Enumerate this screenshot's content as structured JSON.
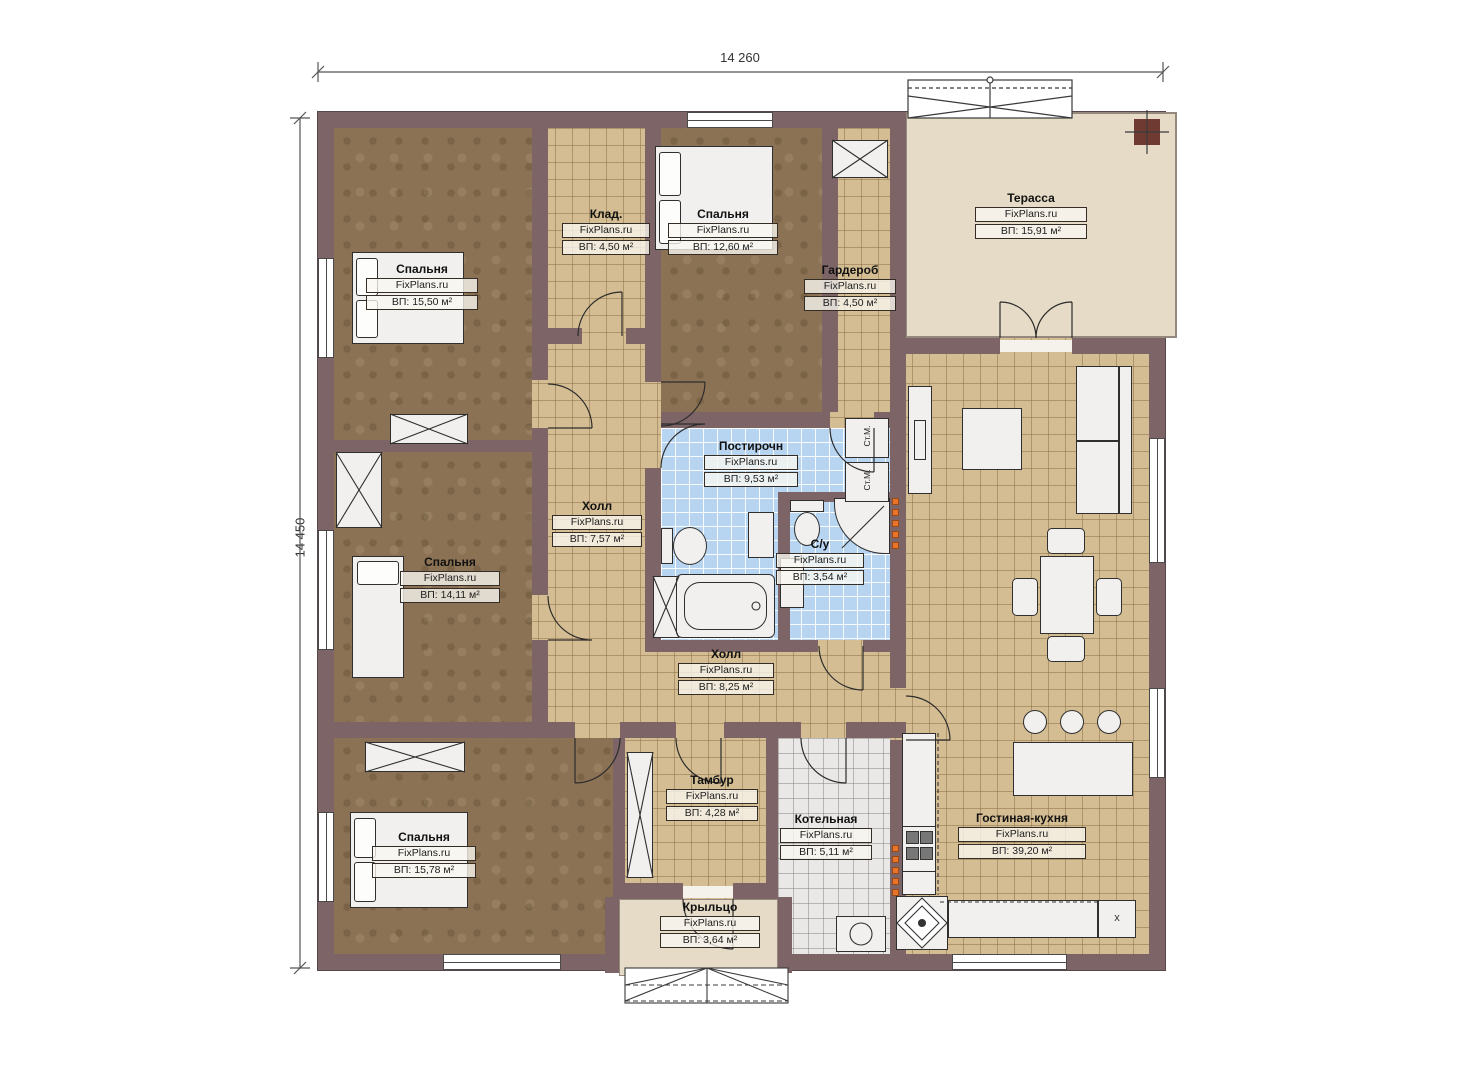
{
  "plan": {
    "type": "floor-plan",
    "site": "FixPlans.ru"
  },
  "dimensions": {
    "top": "14 260",
    "left": "14 450"
  },
  "rooms": [
    {
      "key": "bedroom-top-left",
      "name": "Спальня",
      "watermark": "FixPlans.ru",
      "area": "ВП: 15,50 м²"
    },
    {
      "key": "storage",
      "name": "Клад.",
      "watermark": "FixPlans.ru",
      "area": "ВП: 4,50 м²"
    },
    {
      "key": "bedroom-top-middle",
      "name": "Спальня",
      "watermark": "FixPlans.ru",
      "area": "ВП: 12,60 м²"
    },
    {
      "key": "wardrobe",
      "name": "Гардероб",
      "watermark": "FixPlans.ru",
      "area": "ВП: 4,50 м²"
    },
    {
      "key": "terrace",
      "name": "Терасса",
      "watermark": "FixPlans.ru",
      "area": "ВП: 15,91 м²"
    },
    {
      "key": "laundry",
      "name": "Постирочн",
      "watermark": "FixPlans.ru",
      "area": "ВП: 9,53 м²"
    },
    {
      "key": "hall-small",
      "name": "Холл",
      "watermark": "FixPlans.ru",
      "area": "ВП: 7,57 м²"
    },
    {
      "key": "bathroom",
      "name": "С/у",
      "watermark": "FixPlans.ru",
      "area": "ВП: 3,54 м²"
    },
    {
      "key": "bedroom-middle-left",
      "name": "Спальня",
      "watermark": "FixPlans.ru",
      "area": "ВП: 14,11 м²"
    },
    {
      "key": "hall-big",
      "name": "Холл",
      "watermark": "FixPlans.ru",
      "area": "ВП: 8,25 м²"
    },
    {
      "key": "bedroom-bottom-left",
      "name": "Спальня",
      "watermark": "FixPlans.ru",
      "area": "ВП: 15,78 м²"
    },
    {
      "key": "vestibule",
      "name": "Тамбур",
      "watermark": "FixPlans.ru",
      "area": "ВП: 4,28 м²"
    },
    {
      "key": "boiler-room",
      "name": "Котельная",
      "watermark": "FixPlans.ru",
      "area": "ВП: 5,11 м²"
    },
    {
      "key": "living-kitchen",
      "name": "Гостиная-кухня",
      "watermark": "FixPlans.ru",
      "area": "ВП: 39,20 м²"
    },
    {
      "key": "porch",
      "name": "Крыльцо",
      "watermark": "FixPlans.ru",
      "area": "ВП: 3,64 м²"
    }
  ],
  "appliances": {
    "washer": "Ст.М.",
    "kitchen_unit": "x"
  },
  "colors": {
    "wall": "#7d6466",
    "carpet": "#8b7254",
    "tile_tan": "#d4bd92",
    "tile_blue": "#b7d4f0",
    "tile_gray": "#e9e8e6",
    "terrace": "#e5dbc7",
    "radiator_orange": "#e8742c"
  }
}
